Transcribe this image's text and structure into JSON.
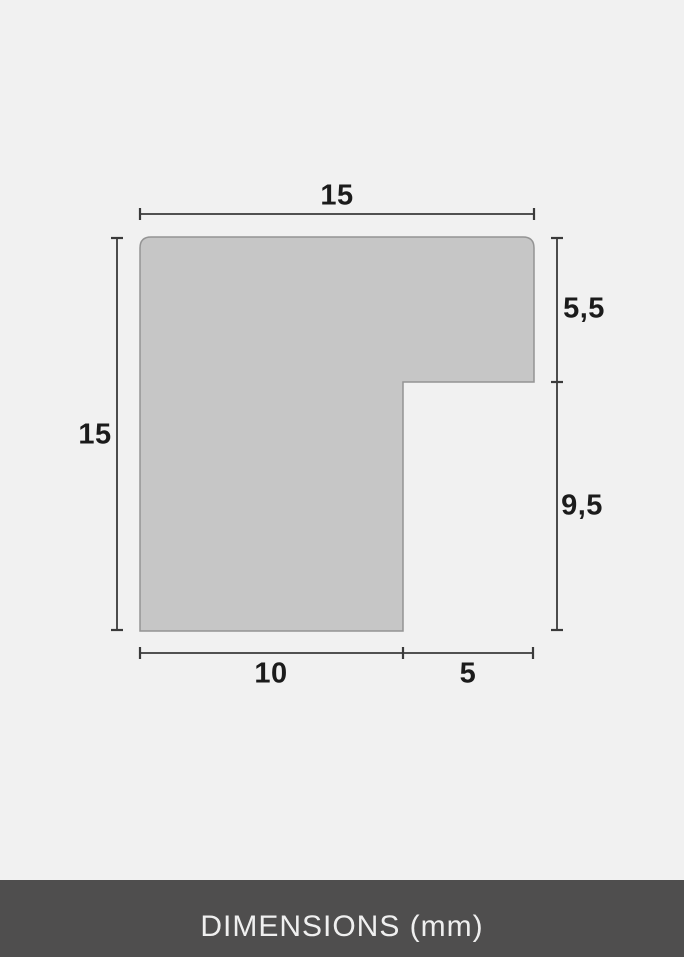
{
  "diagram": {
    "dimensions": {
      "top": "15",
      "left": "15",
      "right_upper": "5,5",
      "right_lower": "9,5",
      "bottom_left": "10",
      "bottom_right": "5"
    }
  },
  "footer": {
    "label": "DIMENSIONS (mm)"
  },
  "colors": {
    "background": "#f1f1f1",
    "shape_fill": "#c6c6c6",
    "shape_border": "#949494",
    "dimension_line": "#3a3a3a",
    "label_text": "#1b1b1b",
    "footer_background": "#4f4e4e",
    "footer_text": "#efefef"
  }
}
